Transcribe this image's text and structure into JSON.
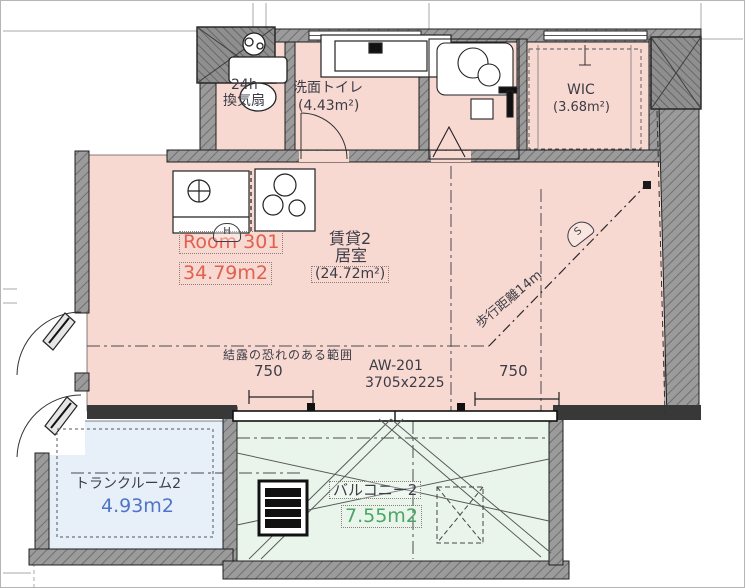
{
  "colors": {
    "room_fill": "#f7d9d2",
    "trunk_fill": "#e7eff9",
    "balcony_fill": "#e9f5eb",
    "wall_gray": "#9a9a9a",
    "wall_dark": "#383838",
    "line": "#2a2a2a",
    "red_text": "#e2604e",
    "blue_text": "#4f74c8",
    "green_text": "#4aa763",
    "dark_text": "#3c3c46"
  },
  "rooms": {
    "unit": {
      "number": "Room 301",
      "area": "34.79m2"
    },
    "main": {
      "name_line1": "賃貸2",
      "name_line2": "居室",
      "area": "(24.72m²)"
    },
    "washroom": {
      "name": "洗面トイレ",
      "area": "(4.43m²)"
    },
    "wic": {
      "name": "WIC",
      "area": "(3.68m²)"
    },
    "trunk": {
      "name": "トランクルーム2",
      "area": "4.93m2"
    },
    "balcony": {
      "name": "バルコニー2",
      "area": "7.55m2"
    },
    "vent": {
      "line1": "24h",
      "line2": "換気扇"
    }
  },
  "annotations": {
    "walk_distance": "歩行距離14m",
    "note": "結露の恐れのある範囲",
    "window_id": "AW-201",
    "window_size": "3705x2225",
    "dim_left": "750",
    "dim_right": "750",
    "sensor_h": "H",
    "sensor_s": "S"
  }
}
